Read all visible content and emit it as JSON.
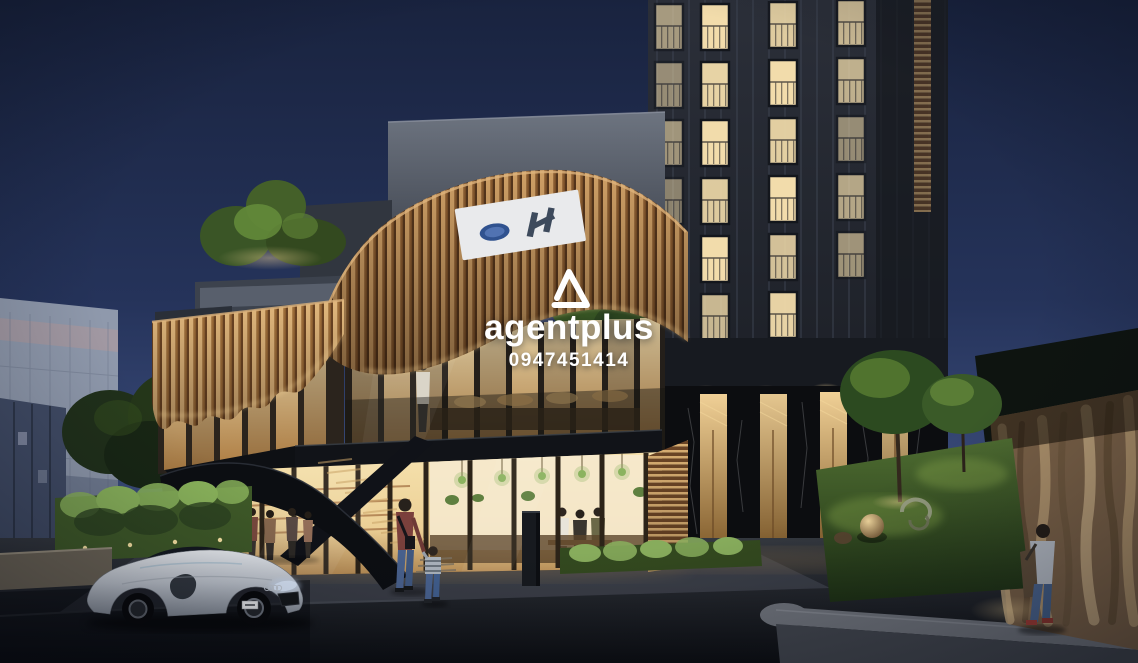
{
  "watermark": {
    "brand": "agentplus",
    "phone": "0947451414",
    "logo_icon": "triangle-delta-icon",
    "color": "#ffffff"
  },
  "scene": {
    "type": "architectural-exterior-render",
    "time_of_day": "dusk",
    "signboard": "white board with two small brand marks (illegible)",
    "objects": [
      "mixed-use podium building with wavy timber-fin facade",
      "glass cafe and library with warm lit interior and green pendant lamps",
      "external black sculptural staircase",
      "high-rise tower with lit balcony windows and black marble base",
      "silver sports car on street",
      "adult walking with child",
      "man walking along illuminated stone wall",
      "lawn with spherical sculptures and uplit trees",
      "rooftop garden trees",
      "background white apartment block"
    ],
    "palette": {
      "sky_top": "#19233f",
      "sky_horizon": "#55689c",
      "timber_fins": "#cfa066",
      "warm_interior": "#f4dfae",
      "tower_facade": "#262a33",
      "marble_base": "#0c0d10",
      "lawn": "#44632c",
      "asphalt": "#15171b",
      "car_silver": "#c3c9d2",
      "pendant_lamp_green": "#8cb35f"
    }
  }
}
